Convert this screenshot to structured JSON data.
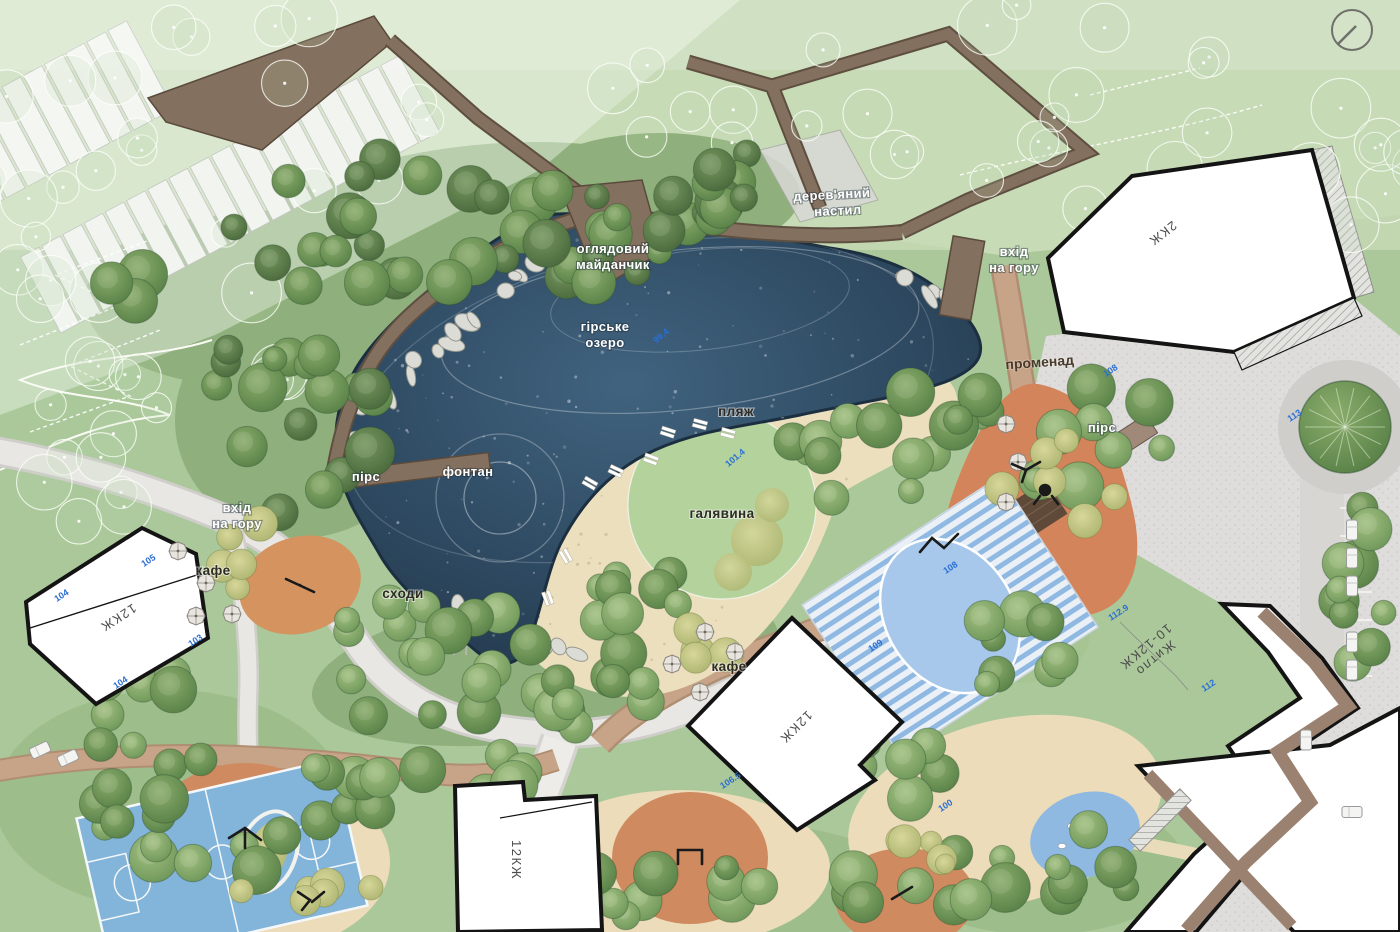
{
  "map": {
    "type": "landscape-masterplan",
    "labels": {
      "wooden_deck_1": "дерев'яний",
      "wooden_deck_2": "настил",
      "viewing_platform_1": "оглядовий",
      "viewing_platform_2": "майданчик",
      "lake_1": "гірське",
      "lake_2": "озеро",
      "beach": "пляж",
      "lawn": "галявина",
      "fountain": "фонтан",
      "pier_left": "пірс",
      "pier_right": "пірс",
      "stairs": "сходи",
      "cafe_left": "кафе",
      "cafe_center": "кафе",
      "promenade": "променад",
      "hill_entrance_left_1": "вхід",
      "hill_entrance_left_2": "на гору",
      "hill_entrance_right_1": "вхід",
      "hill_entrance_right_2": "на гору"
    },
    "buildings": {
      "b_2kzh": "2КЖ",
      "b_12kzh_left": "12КЖ",
      "b_12kzh_center": "12КЖ",
      "b_12kzh_bottom": "12КЖ",
      "b_right_1": "Житло",
      "b_right_2": "10-12КЖ"
    },
    "elevations": [
      "105",
      "104",
      "103",
      "104",
      "101.4",
      "99.4",
      "108",
      "112.9",
      "112",
      "113",
      "109",
      "106.5",
      "100",
      "108"
    ],
    "colors": {
      "lake_deep": "#22374a",
      "lake_mid": "#2f4b63",
      "lake_light": "#40627f",
      "grass": "#aac89a",
      "grass_light": "#c6dab5",
      "forest_green": "#4f7a45",
      "sand": "#ecdfbe",
      "lawn_green": "#b3d29c",
      "deck_brown": "#84705e",
      "promenade_brick": "#c7a487",
      "road_gray": "#e8e7e3",
      "plaza_gray": "#dedddb",
      "building_fill": "#ffffff",
      "building_stroke": "#141414",
      "terrace_brown": "#9b8170",
      "play_orange": "#d4845a",
      "court_blue": "#83b4d9",
      "pool_blue": "#a7c8ea",
      "elevation_blue": "#2b6fd3"
    }
  }
}
